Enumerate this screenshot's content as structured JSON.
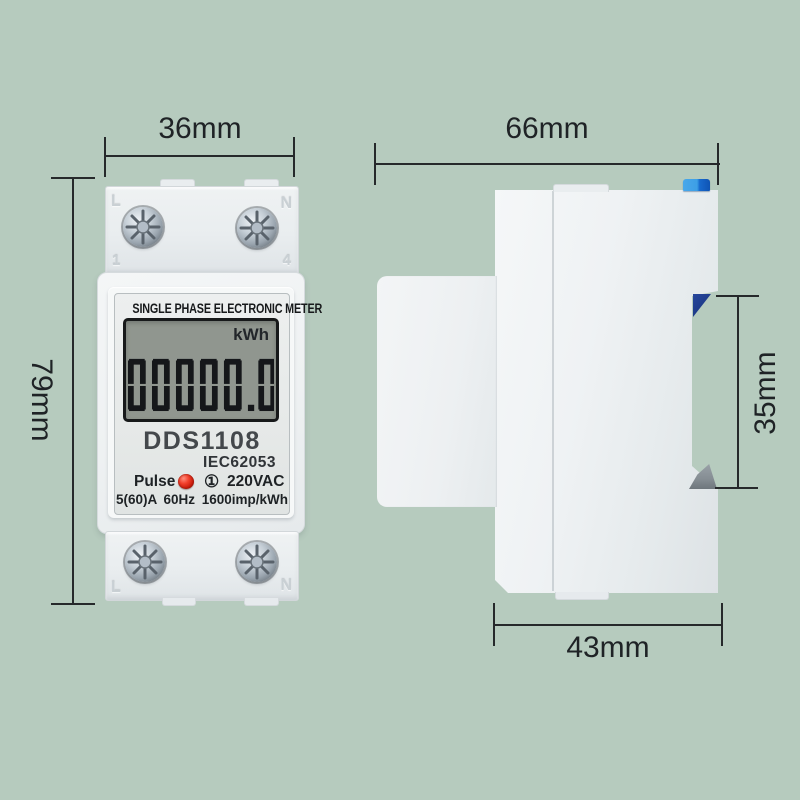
{
  "scene": {
    "description": "Dimension diagram of single phase DIN-rail electronic energy meter, front and side views",
    "background_color": "#b6cbbe"
  },
  "dimensions": {
    "front_width": "36mm",
    "front_height": "79mm",
    "side_depth": "66mm",
    "din_slot_height": "35mm",
    "base_depth": "43mm"
  },
  "front_view": {
    "title": "SINGLE PHASE ELECTRONIC METER",
    "lcd": {
      "unit": "kWh",
      "value": "00000.0"
    },
    "model": "DDS1108",
    "standard": "IEC62053",
    "pulse_label": "Pulse",
    "phase_symbol": "①",
    "voltage": "220VAC",
    "spec_line": "5(60)A 60Hz 1600imp/kWh",
    "terminals": {
      "top_left": "L",
      "top_right": "N",
      "top_left_num": "1",
      "top_right_num": "4",
      "bottom_left": "L",
      "bottom_right": "N"
    }
  },
  "colors": {
    "background": "#b6cbbe",
    "meter_body": "#eff2f3",
    "lcd_screen": "#90968f",
    "lcd_digits": "#15171a",
    "pulse_led": "#e53228",
    "din_clip_blue_light": "#3fa3e8",
    "din_clip_blue_dark": "#1565c8",
    "din_wedge_navy": "#1d3a88",
    "din_wedge_gray": "#858d93",
    "dimension_lines": "#26292b"
  }
}
